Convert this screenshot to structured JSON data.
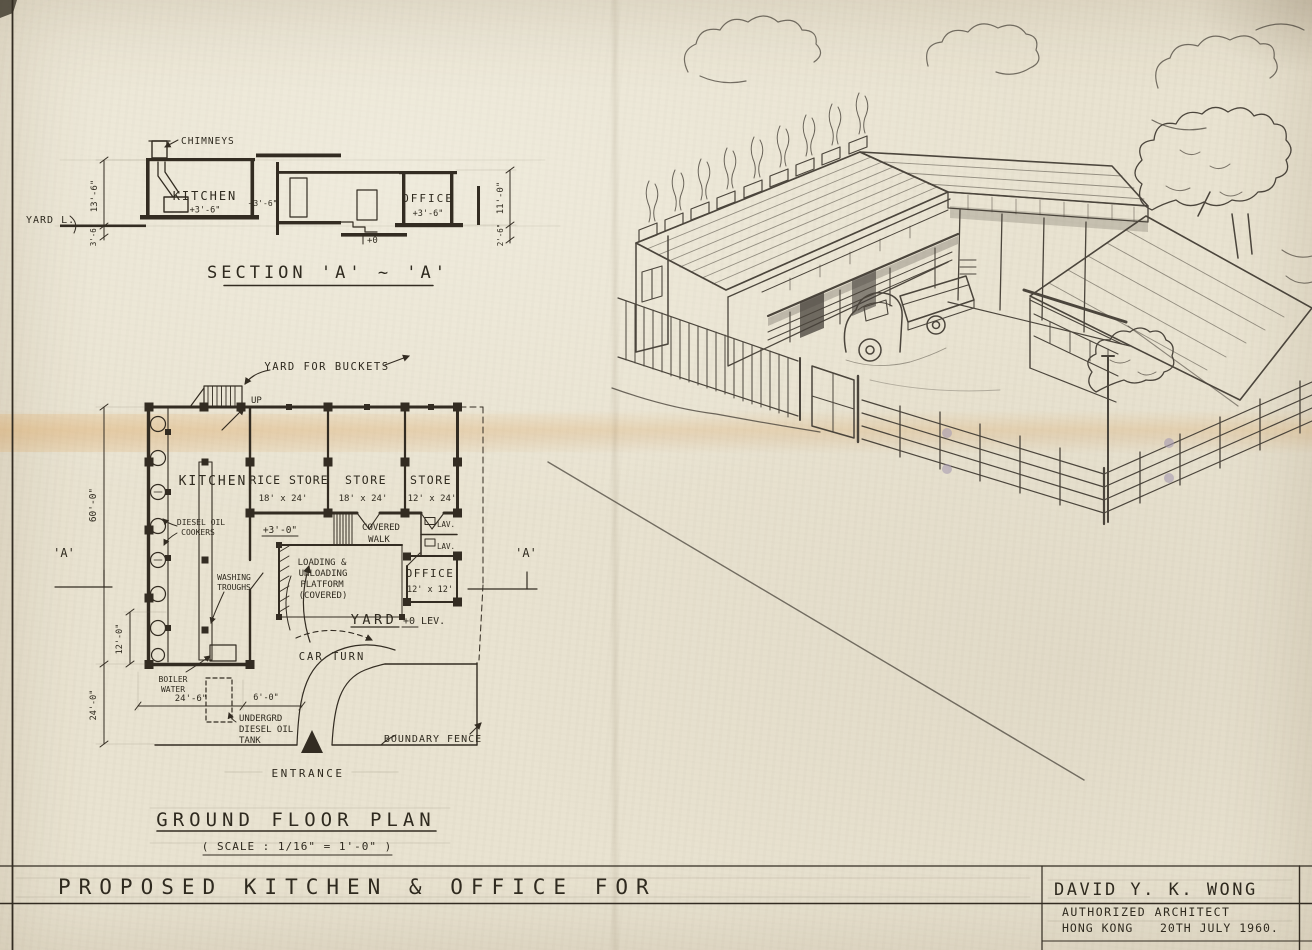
{
  "sheet": {
    "project_title": "PROPOSED  KITCHEN  &  OFFICE  FOR",
    "architect": {
      "name": "DAVID Y. K. WONG",
      "credential": "AUTHORIZED ARCHITECT",
      "place": "HONG KONG",
      "date": "20TH JULY 1960."
    }
  },
  "section": {
    "title": "SECTION  'A' ~ 'A'",
    "chimneys": "CHIMNEYS",
    "kitchen": "KITCHEN",
    "kitchen_level": "+3'-6\"",
    "mid_level": "+3'-6\"",
    "office": "OFFICE",
    "office_level": "+3'-6\"",
    "yard": "YARD L.",
    "datum": "+0",
    "dim_left": "13'-6\"",
    "dim_left_small": "3'-6\"",
    "dim_right": "11'-0\"",
    "dim_right_small": "2'-6\""
  },
  "plan": {
    "title": "GROUND  FLOOR  PLAN",
    "scale": "( SCALE :  1/16\" = 1'-0\" )",
    "yard_for_buckets": "YARD FOR BUCKETS",
    "up": "UP",
    "kitchen": "KITCHEN",
    "rice_store": "RICE STORE",
    "rice_store_size": "18' x 24'",
    "store_1": "STORE",
    "store_1_size": "18' x 24'",
    "store_2": "STORE",
    "store_2_size": "12' x 24'",
    "office": "OFFICE",
    "office_size": "12' x 12'",
    "lav_1": "LAV.",
    "lav_2": "LAV.",
    "covered_walk": [
      "COVERED",
      "WALK"
    ],
    "diesel_cookers": [
      "DIESEL OIL",
      "COOKERS"
    ],
    "washing_troughs": [
      "WASHING",
      "TROUGHS"
    ],
    "loading_platform": [
      "LOADING &",
      "UNLOADING",
      "PLATFORM",
      "(COVERED)"
    ],
    "platform_level": "+3'-0\"",
    "yard": "YARD",
    "yard_level": "+0  LEV.",
    "car_turn": "CAR TURN",
    "boiler_water": [
      "BOILER",
      "WATER"
    ],
    "tank": [
      "UNDERGRD",
      "DIESEL OIL",
      "TANK"
    ],
    "boundary_fence": "BOUNDARY FENCE",
    "entrance": "ENTRANCE",
    "marker_a": "'A'",
    "dim_60": "60'-0\"",
    "dim_12": "12'-0\"",
    "dim_24v": "24'-0\"",
    "dim_24h": "24'-6\"",
    "dim_6": "6'-0\""
  }
}
